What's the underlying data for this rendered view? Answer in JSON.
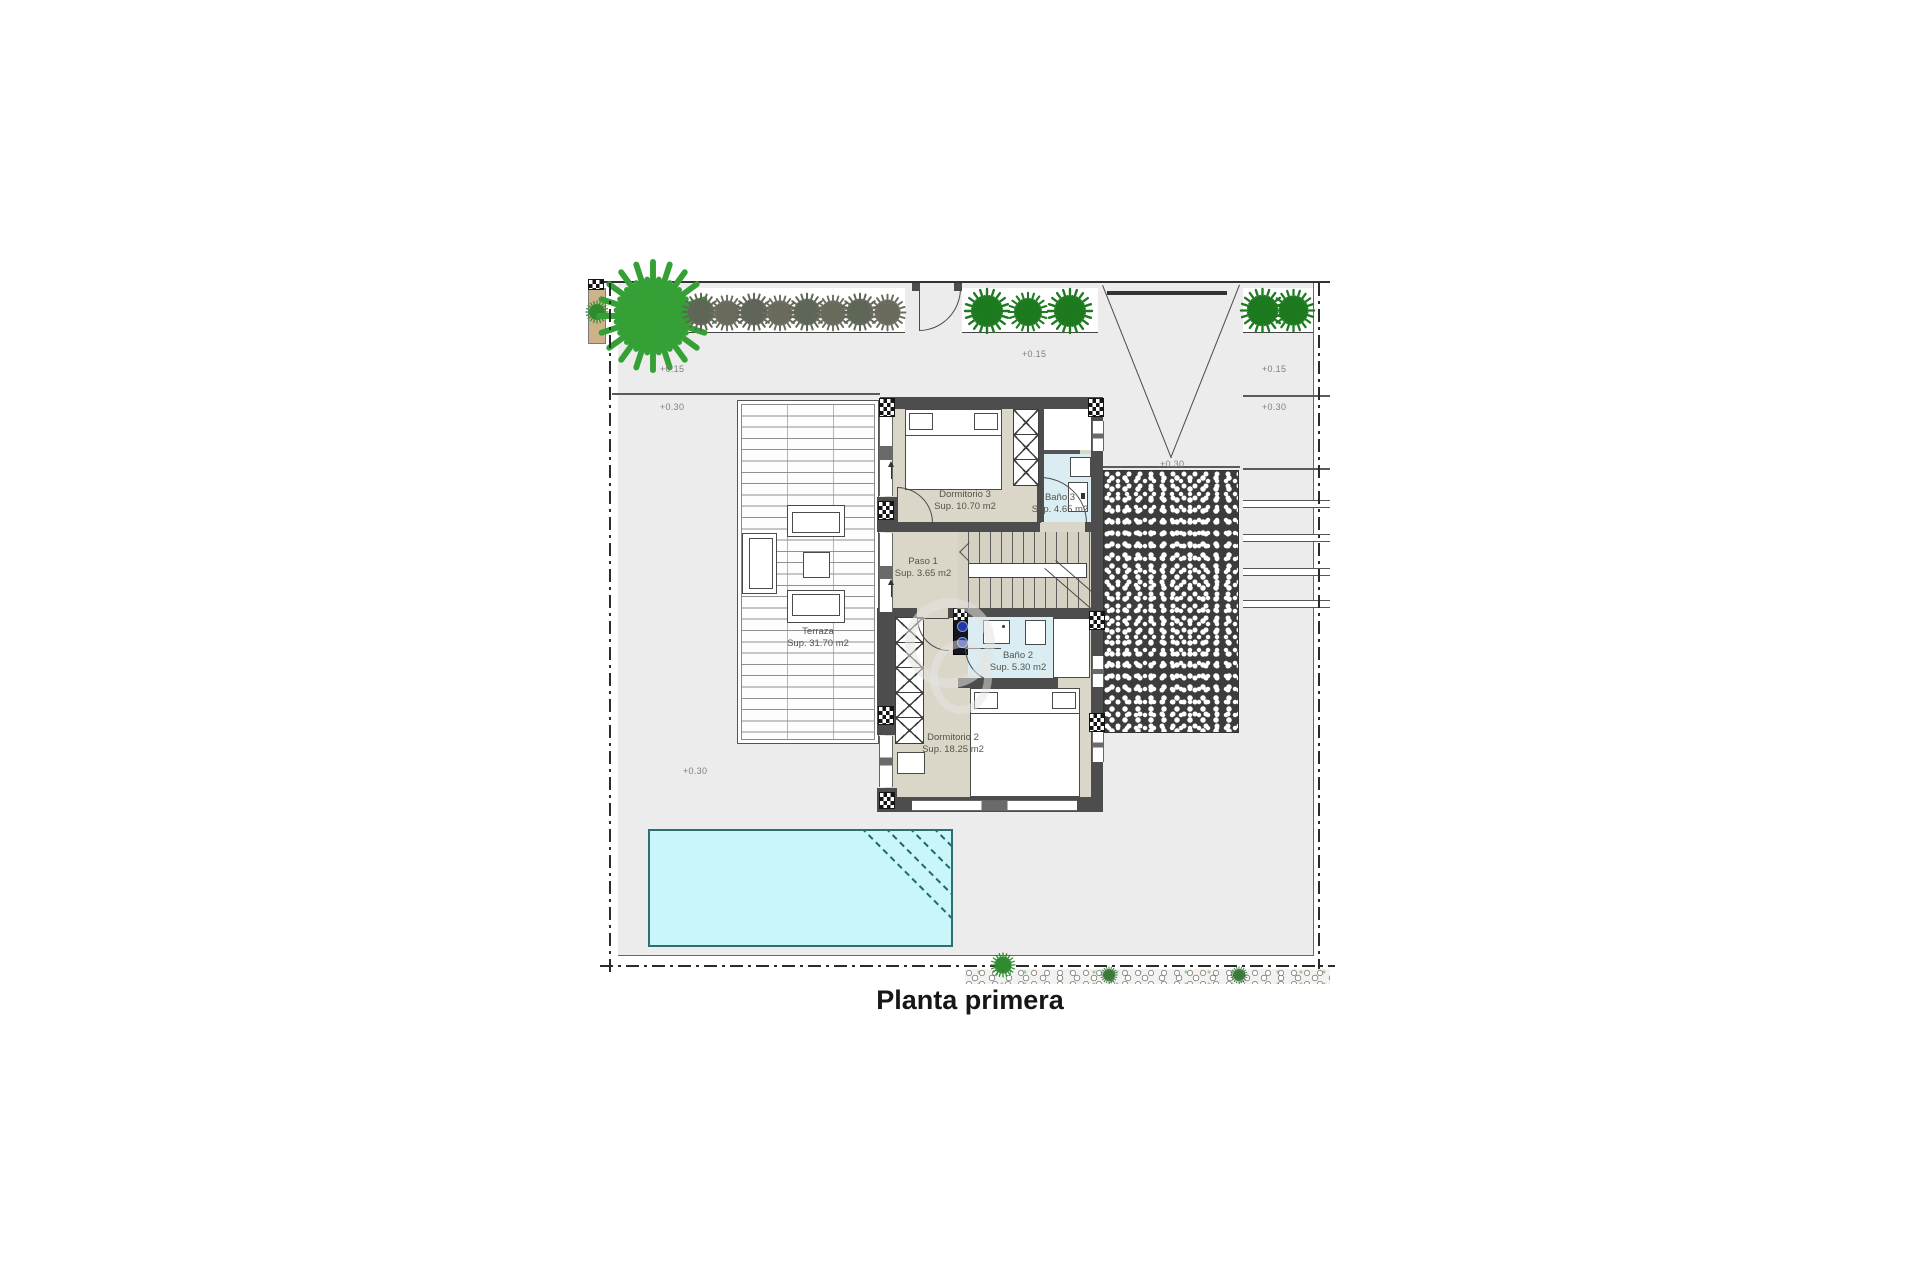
{
  "title": "Planta primera",
  "rooms": {
    "dorm3": {
      "name": "Dormitorio 3",
      "area": "Sup. 10.70 m2"
    },
    "bano3": {
      "name": "Baño 3",
      "area": "Sup. 4.65 m2"
    },
    "paso1": {
      "name": "Paso 1",
      "area": "Sup. 3.65 m2"
    },
    "terraza": {
      "name": "Terraza",
      "area": "Sup. 31.70 m2"
    },
    "bano2": {
      "name": "Baño 2",
      "area": "Sup. 5.30 m2"
    },
    "dorm2": {
      "name": "Dormitorio 2",
      "area": "Sup. 18.25 m2"
    }
  },
  "levels": {
    "l15": "+0.15",
    "l30": "+0.30"
  },
  "colors": {
    "plot_gray": "#ececec",
    "wall_dark": "#4d4d4d",
    "room_beige": "#dad6c8",
    "bath_blue": "#d9edf2",
    "pool_cyan": "#c9f6f9",
    "palm_green": "#1d7a1f",
    "palm_gray": "#5f6657",
    "planter_tan": "#cdb28a"
  }
}
